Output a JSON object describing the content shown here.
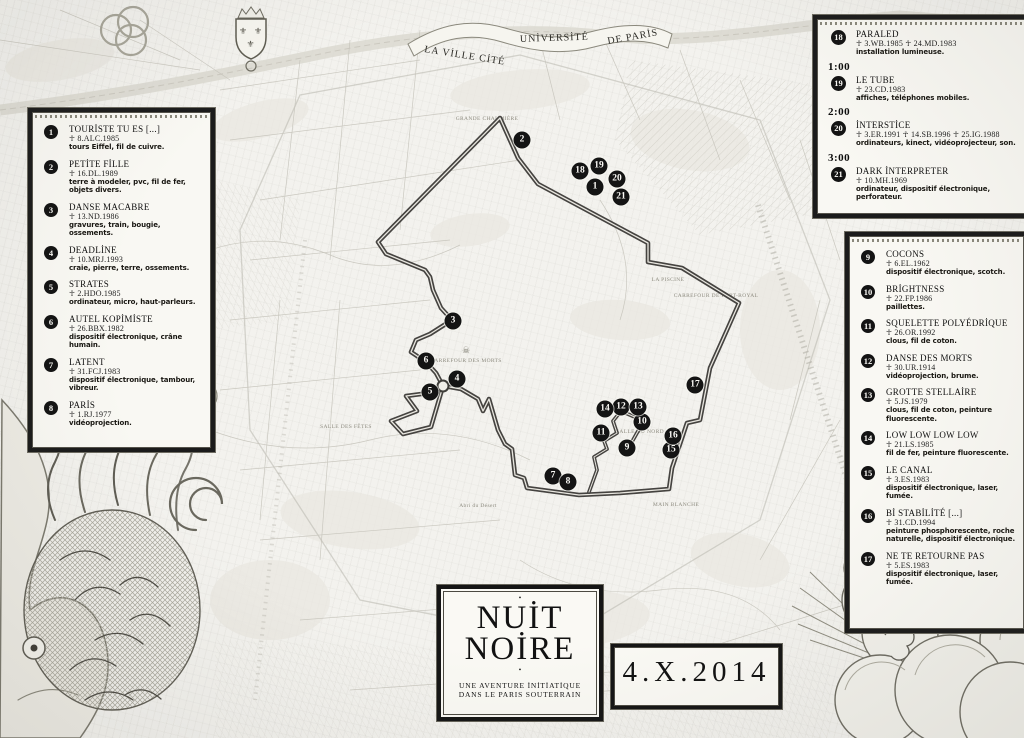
{
  "colors": {
    "paper": "#f3f2ee",
    "ink": "#141414",
    "panel_bg": "#f9f8f3",
    "route": "#454340",
    "marker_bg": "#141414",
    "marker_fg": "#fbfaf6",
    "engraving": "#b9b7ae"
  },
  "banner": {
    "ville": "LA VİLLE CİTÉ",
    "universite": "UNİVERSİTÉ",
    "paris": "DE PARİS"
  },
  "title_box": {
    "top_dot": "•",
    "line1": "NUİT",
    "line2": "NOİRE",
    "bottom_dot": "•",
    "subtitle1": "UNE AVENTURE İNİTİATİQUE",
    "subtitle2": "DANS LE PARIS SOUTERRAIN"
  },
  "date_box": {
    "date": "4.X.2014"
  },
  "legend_left": {
    "items": [
      {
        "n": "1",
        "title": "TOURİSTE TU ES [...]",
        "code": "☥ 8.ALC.1985",
        "materials": "tours Eiffel, fil de cuivre."
      },
      {
        "n": "2",
        "title": "PETİTE FİLLE",
        "code": "☥ 16.DL.1989",
        "materials": "terre à modeler, pvc, fil de fer, objets divers."
      },
      {
        "n": "3",
        "title": "DANSE MACABRE",
        "code": "☥ 13.ND.1986",
        "materials": "gravures, train, bougie, ossements."
      },
      {
        "n": "4",
        "title": "DEADLİNE",
        "code": "☥ 10.MRJ.1993",
        "materials": "craie, pierre, terre, ossements."
      },
      {
        "n": "5",
        "title": "STRATES",
        "code": "☥ 2.HDO.1985",
        "materials": "ordinateur, micro, haut-parleurs."
      },
      {
        "n": "6",
        "title": "AUTEL KOPİMİSTE",
        "code": "☥ 26.BBX.1982",
        "materials": "dispositif électronique, crâne humain."
      },
      {
        "n": "7",
        "title": "LATENT",
        "code": "☥ 31.FCJ.1983",
        "materials": "dispositif électronique, tambour, vibreur."
      },
      {
        "n": "8",
        "title": "PARİS",
        "code": "☥ 1.RJ.1977",
        "materials": "vidéoprojection."
      }
    ]
  },
  "legend_right": {
    "items": [
      {
        "n": "9",
        "title": "COCONS",
        "code": "☥ 6.EL.1962",
        "materials": "dispositif électronique, scotch."
      },
      {
        "n": "10",
        "title": "BRİGHTNESS",
        "code": "☥ 22.FP.1986",
        "materials": "paillettes."
      },
      {
        "n": "11",
        "title": "SQUELETTE POLYÉDRİQUE",
        "code": "☥ 26.OR.1992",
        "materials": "clous, fil de coton."
      },
      {
        "n": "12",
        "title": "DANSE DES MORTS",
        "code": "☥ 30.UR.1914",
        "materials": "vidéoprojection, brume."
      },
      {
        "n": "13",
        "title": "GROTTE STELLAİRE",
        "code": "☥ 5.JS.1979",
        "materials": "clous, fil de coton, peinture fluorescente."
      },
      {
        "n": "14",
        "title": "LOW LOW LOW LOW",
        "code": "☥ 21.LS.1985",
        "materials": "fil de fer, peinture fluorescente."
      },
      {
        "n": "15",
        "title": "LE CANAL",
        "code": "☥ 3.ES.1983",
        "materials": "dispositif électronique, laser, fumée."
      },
      {
        "n": "16",
        "title": "Bİ STABİLİTÉ [...]",
        "code": "☥ 31.CD.1994",
        "materials": "peinture phosphorescente, roche naturelle, dispositif électronique."
      },
      {
        "n": "17",
        "title": "NE TE RETOURNE PAS",
        "code": "☥ 5.ES.1983",
        "materials": "dispositif électronique, laser, fumée."
      }
    ]
  },
  "legend_topright": {
    "items": [
      {
        "n": "18",
        "time": "",
        "title": "PARALED",
        "code": "☥ 3.WB.1985  ☥ 24.MD.1983",
        "materials": "installation lumineuse."
      },
      {
        "n": "19",
        "time": "1:00",
        "title": "LE TUBE",
        "code": "☥ 23.CD.1983",
        "materials": "affiches, téléphones mobiles."
      },
      {
        "n": "20",
        "time": "2:00",
        "title": "İNTERSTİCE",
        "code": "☥ 3.ER.1991  ☥ 14.SB.1996  ☥ 25.IG.1988",
        "materials": "ordinateurs, kinect, vidéoprojecteur, son."
      },
      {
        "n": "21",
        "time": "3:00",
        "title": "DARK İNTERPRETER",
        "code": "☥ 10.MH.1969",
        "materials": "ordinateur, dispositif électronique, perforateur."
      }
    ]
  },
  "map": {
    "markers": [
      {
        "n": "1",
        "x": 595,
        "y": 187
      },
      {
        "n": "2",
        "x": 522,
        "y": 140
      },
      {
        "n": "3",
        "x": 453,
        "y": 321
      },
      {
        "n": "4",
        "x": 457,
        "y": 379
      },
      {
        "n": "5",
        "x": 430,
        "y": 392
      },
      {
        "n": "6",
        "x": 426,
        "y": 361
      },
      {
        "n": "7",
        "x": 553,
        "y": 476
      },
      {
        "n": "8",
        "x": 568,
        "y": 482
      },
      {
        "n": "9",
        "x": 627,
        "y": 448
      },
      {
        "n": "10",
        "x": 642,
        "y": 422
      },
      {
        "n": "11",
        "x": 601,
        "y": 433
      },
      {
        "n": "12",
        "x": 621,
        "y": 407
      },
      {
        "n": "13",
        "x": 638,
        "y": 407
      },
      {
        "n": "14",
        "x": 605,
        "y": 409
      },
      {
        "n": "15",
        "x": 671,
        "y": 450
      },
      {
        "n": "16",
        "x": 673,
        "y": 436
      },
      {
        "n": "17",
        "x": 695,
        "y": 385
      },
      {
        "n": "18",
        "x": 580,
        "y": 171
      },
      {
        "n": "19",
        "x": 599,
        "y": 166
      },
      {
        "n": "20",
        "x": 617,
        "y": 179
      },
      {
        "n": "21",
        "x": 621,
        "y": 197
      }
    ],
    "ring_node": {
      "x": 443,
      "y": 386
    },
    "skull": {
      "x": 466,
      "y": 351,
      "glyph": "☠"
    },
    "route": {
      "color": "#454340",
      "loop": [
        [
          500,
          118
        ],
        [
          518,
          158
        ],
        [
          538,
          184
        ],
        [
          648,
          243
        ],
        [
          648,
          262
        ],
        [
          682,
          268
        ],
        [
          739,
          303
        ],
        [
          727,
          330
        ],
        [
          710,
          368
        ],
        [
          700,
          420
        ],
        [
          687,
          423
        ],
        [
          672,
          468
        ],
        [
          669,
          489
        ],
        [
          620,
          493
        ],
        [
          579,
          495
        ],
        [
          542,
          490
        ],
        [
          527,
          488
        ],
        [
          524,
          478
        ],
        [
          515,
          475
        ],
        [
          512,
          449
        ],
        [
          505,
          444
        ],
        [
          498,
          430
        ],
        [
          489,
          399
        ],
        [
          483,
          411
        ],
        [
          478,
          399
        ],
        [
          461,
          389
        ],
        [
          444,
          386
        ],
        [
          429,
          393
        ],
        [
          406,
          396
        ],
        [
          417,
          411
        ],
        [
          391,
          421
        ],
        [
          403,
          434
        ],
        [
          431,
          427
        ],
        [
          443,
          386
        ],
        [
          436,
          373
        ],
        [
          426,
          362
        ],
        [
          411,
          352
        ],
        [
          416,
          340
        ],
        [
          430,
          334
        ],
        [
          452,
          320
        ],
        [
          441,
          308
        ],
        [
          433,
          290
        ],
        [
          430,
          277
        ],
        [
          425,
          270
        ],
        [
          386,
          254
        ],
        [
          378,
          242
        ],
        [
          500,
          118
        ]
      ],
      "spur": [
        [
          589,
          492
        ],
        [
          597,
          470
        ],
        [
          594,
          457
        ],
        [
          607,
          449
        ],
        [
          604,
          441
        ],
        [
          617,
          433
        ],
        [
          613,
          421
        ],
        [
          621,
          411
        ],
        [
          616,
          403
        ]
      ],
      "branch": [
        [
          621,
          411
        ],
        [
          637,
          418
        ],
        [
          642,
          424
        ],
        [
          633,
          440
        ],
        [
          627,
          449
        ]
      ]
    },
    "labels": [
      {
        "text": "GRANDE CHAUMIÈRE",
        "x": 487,
        "y": 119,
        "r": 0
      },
      {
        "text": "LA PISCINE",
        "x": 668,
        "y": 280,
        "r": 0
      },
      {
        "text": "CARREFOUR DE PORT-ROYAL",
        "x": 716,
        "y": 296,
        "r": 0
      },
      {
        "text": "CARREFOUR DES MORTS",
        "x": 466,
        "y": 361,
        "r": 0
      },
      {
        "text": "SALLE DU NORD",
        "x": 640,
        "y": 432,
        "r": 0
      },
      {
        "text": "MAIN BLANCHE",
        "x": 676,
        "y": 505,
        "r": 0
      },
      {
        "text": "Abri du Désert",
        "x": 478,
        "y": 506,
        "r": 0
      },
      {
        "text": "SALLE DES FÊTES",
        "x": 346,
        "y": 427,
        "r": 0
      }
    ]
  }
}
